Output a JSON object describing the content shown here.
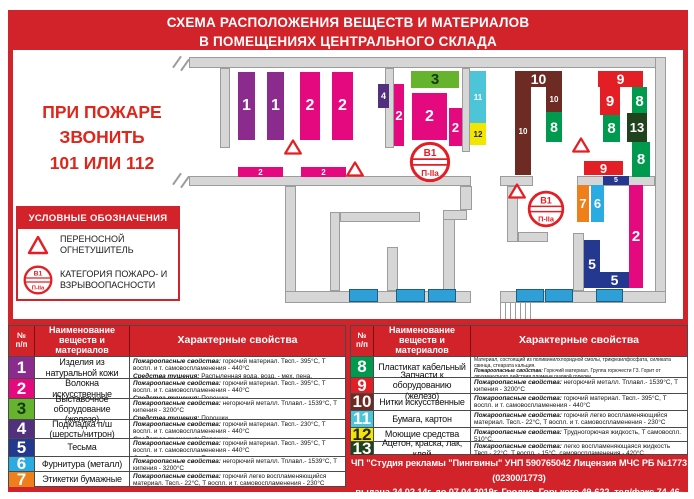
{
  "title": {
    "line1": "СХЕМА РАСПОЛОЖЕНИЯ ВЕЩЕСТВ И МАТЕРИАЛОВ",
    "line2": "В ПОМЕЩЕНИЯХ ЦЕНТРАЛЬНОГО СКЛАДА"
  },
  "emergency": {
    "line1": "ПРИ ПОЖАРЕ ЗВОНИТЬ",
    "line2": "101 ИЛИ 112"
  },
  "legend": {
    "header": "УСЛОВНЫЕ ОБОЗНАЧЕНИЯ",
    "item1": "ПЕРЕНОСНОЙ ОГНЕТУШИТЕЛЬ",
    "item2": "КАТЕГОРИЯ ПОЖАРО- И ВЗРЫВООПАСНОСТИ",
    "sign_top": "В1",
    "sign_bottom": "П-IIa"
  },
  "colors": {
    "red": "#d2232a",
    "sign_red": "#e31e24",
    "wall": "#d6d6d6",
    "window_blue": "#2f9fd8"
  },
  "palette": {
    "1": {
      "bg": "#8a2b8d",
      "fg": "#ffffff"
    },
    "2": {
      "bg": "#e5097f",
      "fg": "#ffffff"
    },
    "3": {
      "bg": "#66b32e",
      "fg": "#153812"
    },
    "4": {
      "bg": "#52307e",
      "fg": "#ffffff"
    },
    "5": {
      "bg": "#24388f",
      "fg": "#ffffff"
    },
    "6": {
      "bg": "#2aabe2",
      "fg": "#ffffff"
    },
    "7": {
      "bg": "#ef7f1b",
      "fg": "#ffffff"
    },
    "8": {
      "bg": "#009a4e",
      "fg": "#ffffff"
    },
    "9": {
      "bg": "#e31e24",
      "fg": "#ffffff"
    },
    "10": {
      "bg": "#6e2b24",
      "fg": "#ffffff"
    },
    "11": {
      "bg": "#4cc5d8",
      "fg": "#ffffff"
    },
    "12": {
      "bg": "#f2e500",
      "fg": "#222222"
    },
    "13": {
      "bg": "#20421c",
      "fg": "#ffffff"
    }
  },
  "plan": {
    "walls": [
      {
        "x": 189,
        "y": 57,
        "w": 477,
        "h": 11
      },
      {
        "x": 655,
        "y": 57,
        "w": 11,
        "h": 246
      },
      {
        "x": 220,
        "y": 68,
        "w": 10,
        "h": 80
      },
      {
        "x": 385,
        "y": 68,
        "w": 9,
        "h": 80
      },
      {
        "x": 462,
        "y": 68,
        "w": 8,
        "h": 84
      },
      {
        "x": 189,
        "y": 176,
        "w": 282,
        "h": 10
      },
      {
        "x": 500,
        "y": 176,
        "w": 33,
        "h": 10
      },
      {
        "x": 577,
        "y": 176,
        "w": 78,
        "h": 10
      },
      {
        "x": 285,
        "y": 186,
        "w": 11,
        "h": 117
      },
      {
        "x": 285,
        "y": 291,
        "w": 186,
        "h": 12
      },
      {
        "x": 500,
        "y": 291,
        "w": 166,
        "h": 12
      },
      {
        "x": 330,
        "y": 212,
        "w": 10,
        "h": 79
      },
      {
        "x": 340,
        "y": 212,
        "w": 80,
        "h": 10
      },
      {
        "x": 387,
        "y": 247,
        "w": 11,
        "h": 44
      },
      {
        "x": 443,
        "y": 210,
        "w": 12,
        "h": 81
      },
      {
        "x": 443,
        "y": 210,
        "w": 24,
        "h": 10
      },
      {
        "x": 460,
        "y": 186,
        "w": 12,
        "h": 24
      },
      {
        "x": 507,
        "y": 186,
        "w": 11,
        "h": 56
      },
      {
        "x": 518,
        "y": 232,
        "w": 30,
        "h": 10
      },
      {
        "x": 573,
        "y": 233,
        "w": 11,
        "h": 58
      }
    ],
    "windows": [
      {
        "x": 349,
        "y": 289,
        "w": 29
      },
      {
        "x": 396,
        "y": 289,
        "w": 29
      },
      {
        "x": 428,
        "y": 289,
        "w": 28
      },
      {
        "x": 516,
        "y": 289,
        "w": 28
      },
      {
        "x": 545,
        "y": 289,
        "w": 28
      },
      {
        "x": 596,
        "y": 289,
        "w": 27
      }
    ],
    "stairs": {
      "x": 500,
      "y": 303,
      "w": 34,
      "h": 16
    },
    "blocks": [
      {
        "n": "1",
        "x": 238,
        "y": 72,
        "w": 17,
        "h": 68,
        "fs": 16
      },
      {
        "n": "1",
        "x": 267,
        "y": 72,
        "w": 17,
        "h": 68,
        "fs": 16
      },
      {
        "n": "2",
        "x": 300,
        "y": 72,
        "w": 20,
        "h": 68,
        "fs": 16
      },
      {
        "n": "2",
        "x": 332,
        "y": 72,
        "w": 21,
        "h": 68,
        "fs": 16
      },
      {
        "n": "4",
        "x": 378,
        "y": 84,
        "w": 11,
        "h": 24,
        "fs": 9
      },
      {
        "n": "2",
        "x": 394,
        "y": 84,
        "w": 10,
        "h": 62,
        "fs": 13
      },
      {
        "n": "3",
        "x": 411,
        "y": 71,
        "w": 48,
        "h": 17,
        "fs": 15
      },
      {
        "n": "2",
        "x": 412,
        "y": 93,
        "w": 35,
        "h": 47,
        "fs": 16
      },
      {
        "n": "2",
        "x": 449,
        "y": 108,
        "w": 13,
        "h": 38,
        "fs": 13
      },
      {
        "n": "11",
        "x": 470,
        "y": 71,
        "w": 16,
        "h": 52,
        "fs": 8
      },
      {
        "n": "12",
        "x": 470,
        "y": 123,
        "w": 16,
        "h": 22,
        "fs": 8
      },
      {
        "n": "2",
        "x": 238,
        "y": 167,
        "w": 45,
        "h": 10,
        "fs": 8
      },
      {
        "n": "2",
        "x": 301,
        "y": 167,
        "w": 45,
        "h": 10,
        "fs": 8
      },
      {
        "n": "10",
        "x": 515,
        "y": 71,
        "w": 47,
        "h": 16,
        "fs": 14
      },
      {
        "n": "10",
        "x": 515,
        "y": 87,
        "w": 16,
        "h": 88,
        "fs": 8
      },
      {
        "n": "10",
        "x": 546,
        "y": 87,
        "w": 16,
        "h": 25,
        "fs": 8
      },
      {
        "n": "8",
        "x": 546,
        "y": 112,
        "w": 16,
        "h": 30,
        "fs": 14
      },
      {
        "n": "9",
        "x": 598,
        "y": 71,
        "w": 45,
        "h": 16,
        "fs": 14
      },
      {
        "n": "9",
        "x": 600,
        "y": 87,
        "w": 20,
        "h": 28,
        "fs": 15
      },
      {
        "n": "8",
        "x": 632,
        "y": 87,
        "w": 15,
        "h": 28,
        "fs": 15
      },
      {
        "n": "8",
        "x": 603,
        "y": 115,
        "w": 17,
        "h": 27,
        "fs": 15
      },
      {
        "n": "13",
        "x": 627,
        "y": 113,
        "w": 20,
        "h": 29,
        "fs": 13
      },
      {
        "n": "8",
        "x": 632,
        "y": 142,
        "w": 18,
        "h": 35,
        "fs": 15
      },
      {
        "n": "9",
        "x": 584,
        "y": 161,
        "w": 39,
        "h": 14,
        "fs": 13
      },
      {
        "n": "5",
        "x": 603,
        "y": 176,
        "w": 26,
        "h": 9,
        "fs": 7
      },
      {
        "n": "7",
        "x": 577,
        "y": 185,
        "w": 12,
        "h": 37,
        "fs": 13
      },
      {
        "n": "6",
        "x": 591,
        "y": 185,
        "w": 13,
        "h": 37,
        "fs": 13
      },
      {
        "n": "2",
        "x": 629,
        "y": 185,
        "w": 14,
        "h": 103,
        "fs": 15
      },
      {
        "n": "5",
        "x": 584,
        "y": 240,
        "w": 16,
        "h": 48,
        "fs": 14
      },
      {
        "n": "5",
        "x": 600,
        "y": 272,
        "w": 29,
        "h": 16,
        "fs": 14
      }
    ],
    "extinguishers": [
      {
        "x": 293,
        "y": 147
      },
      {
        "x": 355,
        "y": 169
      },
      {
        "x": 581,
        "y": 145
      },
      {
        "x": 517,
        "y": 191
      }
    ],
    "signs": [
      {
        "x": 430,
        "y": 162,
        "r": 21,
        "top": "В1",
        "bottom": "П-IIa"
      },
      {
        "x": 546,
        "y": 209,
        "r": 19,
        "top": "В1",
        "bottom": "П-IIa"
      }
    ]
  },
  "tables": {
    "headers": {
      "num": "№\nп/п",
      "name": "Наименование\nвеществ и материалов",
      "props": "Характерные свойства"
    },
    "labels": {
      "fire": "Пожароопасные свойства:",
      "ext": "Средства тушения:"
    },
    "left": [
      {
        "n": "1",
        "name": "Изделия из натуральной кожи",
        "fire": "горючий материал. Твсп.- 395°С, Т воспл. и т. самовоспламенения - 440°С",
        "ext": "Распыленная вода, возд. - мех. пена."
      },
      {
        "n": "2",
        "name": "Волокна искусственные",
        "fire": "горючий материал. Твсп.- 395°С, Т воспл. и т. самовоспламенения - 440°С",
        "ext": "Порошки."
      },
      {
        "n": "3",
        "name": "Выставочное оборудование (железо)",
        "fire": "негорючий металл. Тплавл.- 1539°С, Т кипения - 3200°С",
        "ext": "Порошки."
      },
      {
        "n": "4",
        "name": "Подкладка п/ш (шерсть/нитрон)",
        "fire": "горючий материал. Твсп.- 230°С, Т воспл. и т. самовоспламенения - 440°С",
        "ext": "Порошки."
      },
      {
        "n": "5",
        "name": "Тесьма",
        "fire": "горючий материал. Твсп.- 395°С, Т воспл. и т. самовоспламенения - 440°С",
        "ext": "Порошки."
      },
      {
        "n": "6",
        "name": "Фурнитура (металл)",
        "fire": "негорючий металл. Тплавл.- 1539°С, Т кипения - 3200°С",
        "ext": "Порошки."
      },
      {
        "n": "7",
        "name": "Этикетки бумажные",
        "fire": "горючий легко воспламеняющийся материал. Твсп.- 22°С, Т воспл. и т. самовоспламенения - 230°С",
        "ext": "Распыленная вода со смачивателями, возд. - мех. пена."
      }
    ],
    "right": [
      {
        "n": "8",
        "name": "Пластикат кабельный",
        "pre": "Материал, состоящий из поливинилхлоридной смолы, трикрезилфосфата, силиката свинца, стеарата кальция.",
        "fire": "Горючий материал. Группа горючести Г3. Горит от двухминутного действия пламени газовой горелки.",
        "ext": "Распыленная вода со смачивателями.",
        "small": true
      },
      {
        "n": "9",
        "name": "Запчасти к оборудованию (железо)",
        "fire": "негорючий металл. Тплавл.- 1539°С, Т кипения - 3200°С",
        "ext": "Порошки."
      },
      {
        "n": "10",
        "name": "Нитки искусственные",
        "fire": "горючий материал. Твсп.- 395°С, Т воспл. и т. самовоспламенения - 440°С",
        "ext": "Распыленная вода. Порошки."
      },
      {
        "n": "11",
        "name": "Бумага, картон",
        "fire": "горючий легко воспламеняющийся материал. Твсп.- 22°С, Т воспл. и т. самовоспламенения - 230°С",
        "ext": "Распыленная вода со смачивателями, возд. - мех. пена."
      },
      {
        "n": "12",
        "name": "Моющие средства",
        "fire": "Трудногорючая жидкость, Т самовоспл. 510°С.",
        "ext": "Распыленная вода."
      },
      {
        "n": "13",
        "name": "Ацетон, краска, лак, клей",
        "fire": "легко воспламеняющаяся жидкость Твсп.- 22°С, Т воспл. - 15°С, самовоспламенения - 420°С",
        "ext": "Возд. - мех. пена, порошки."
      }
    ]
  },
  "footer": {
    "line1": "ЧП \"Студия рекламы \"Пингвины\" УНП 590765042 Лицензия МЧС РБ №1773 (02300/1773)",
    "line2": "выдана 24.02.14г. до 07.04.2019г. Гродно, Горького 49-622, тел/факс 74-46-49, 7-816491, 3-687643"
  },
  "watermark": "СУВЕНИРКИН.БЕЛ"
}
